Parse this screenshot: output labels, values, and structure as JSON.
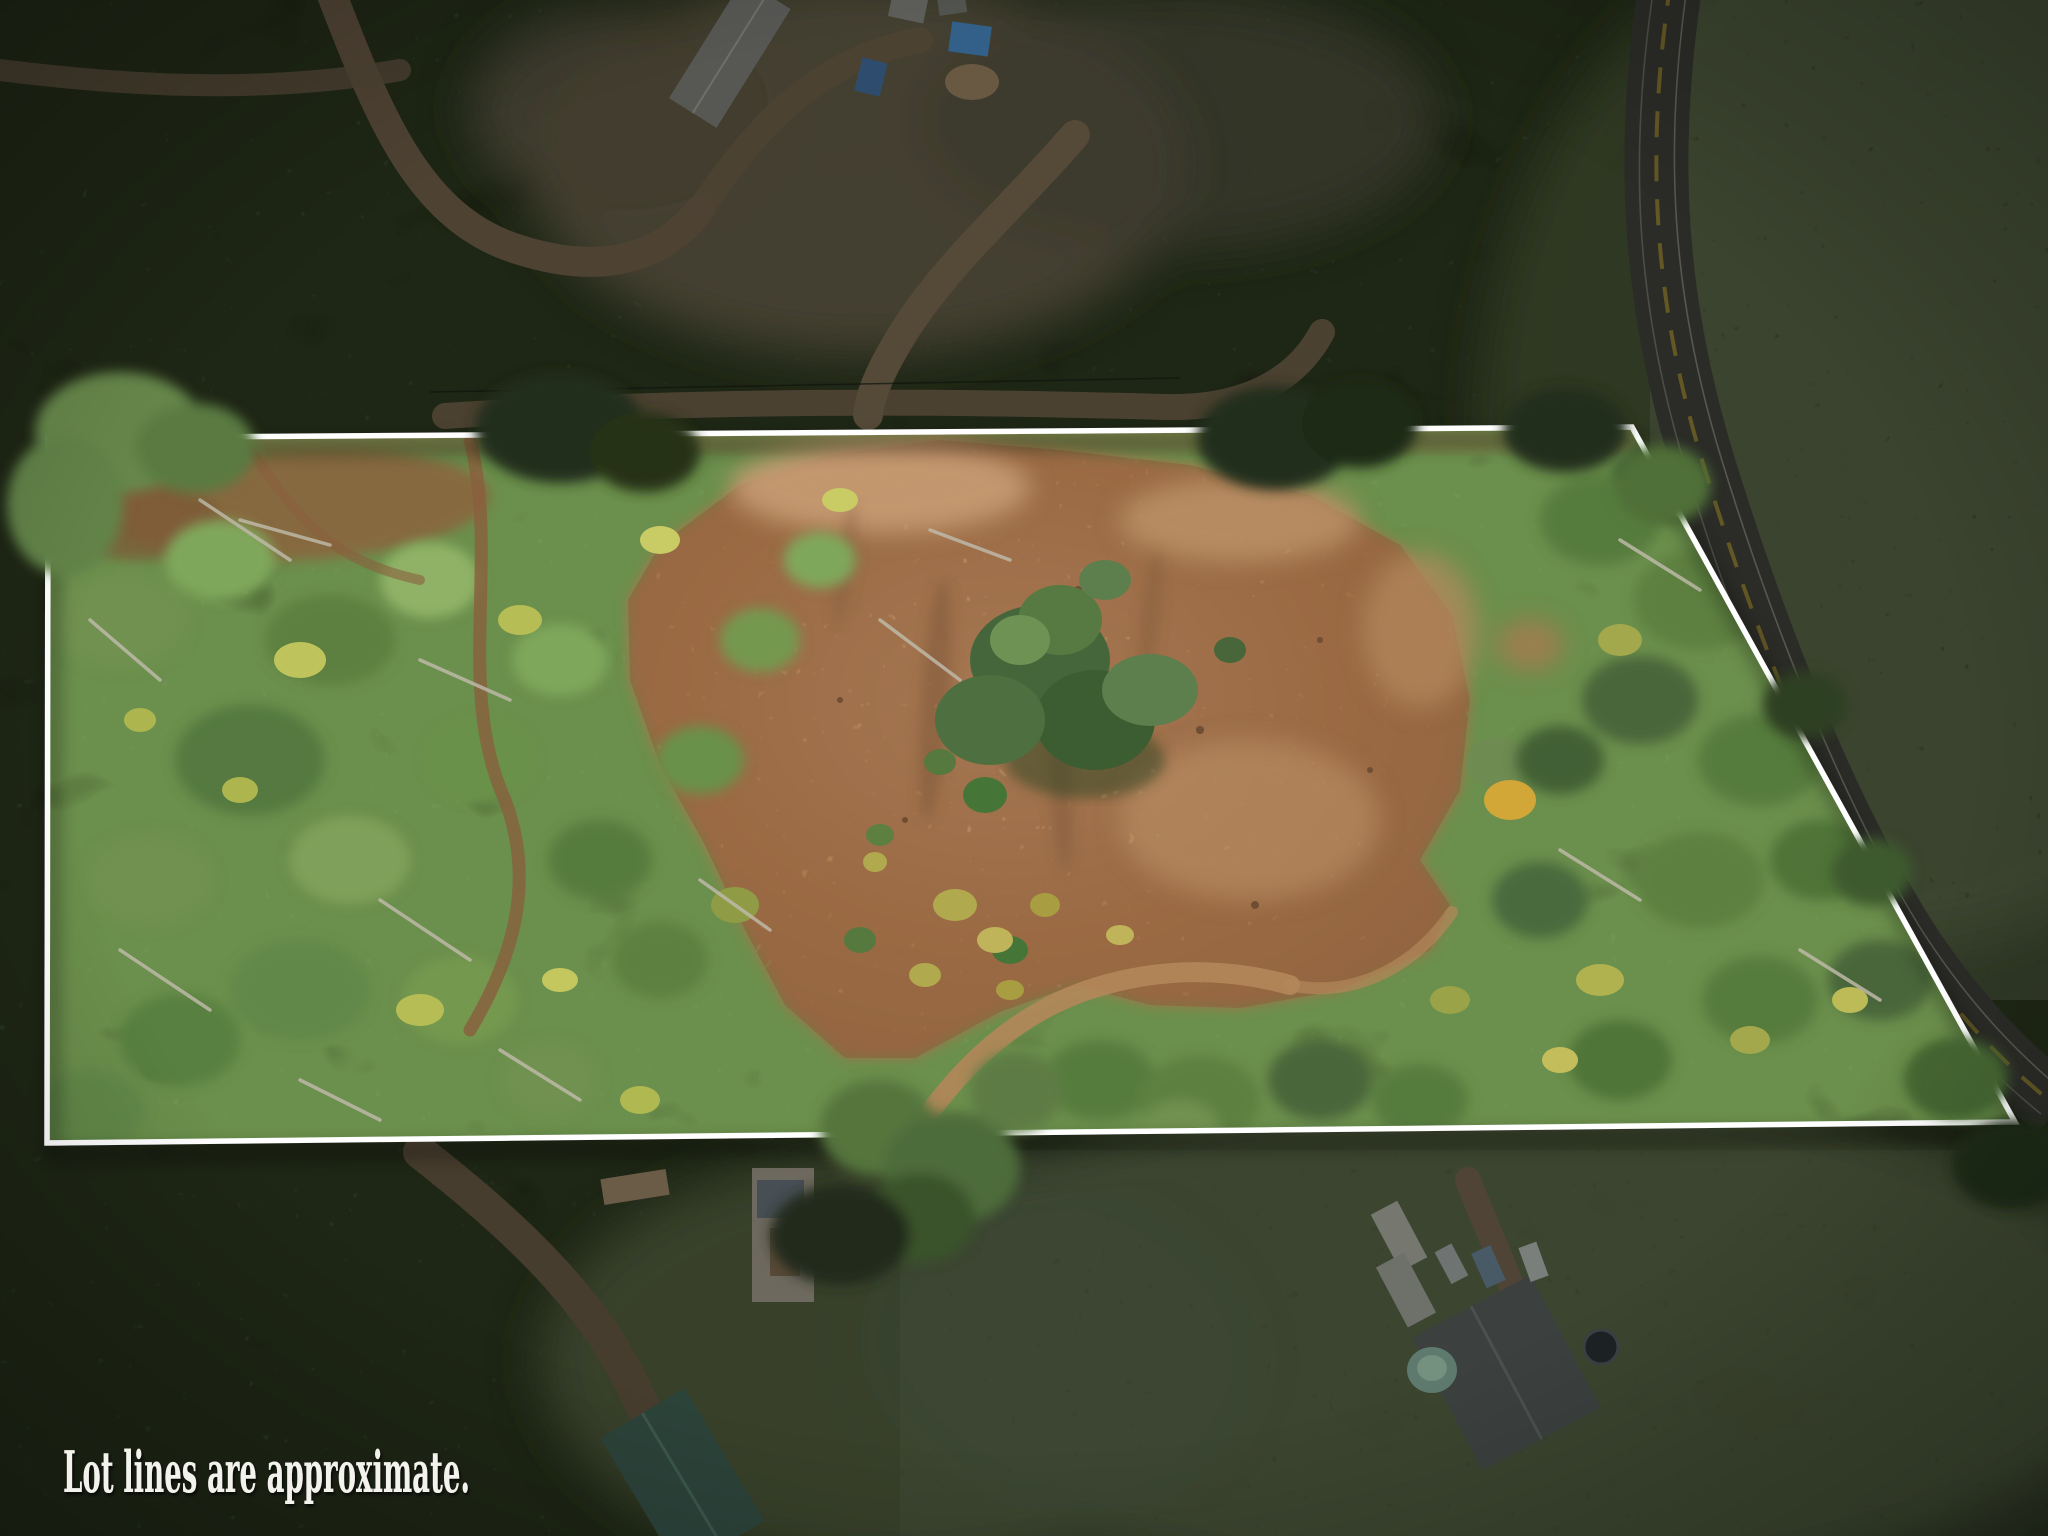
{
  "scene": {
    "type": "aerial-drone-photograph",
    "subject": "Top-down drone photo of a rectangular wooded lot outlined in white; interior is brightly lit with green tree canopy and a brown cleared dirt area, while everything outside the lot lines (neighboring homes, dirt roads, a paved road, fields and forest) is darkened",
    "caption": {
      "text": "Lot lines are approximate."
    }
  },
  "lot": {
    "polygon_points": "48,438 1632,427 2015,1122 47,1143",
    "boundary_color": "#ffffff"
  },
  "palette": {
    "boundary-white": "#ffffff",
    "caption-white": "#f4f2ec",
    "forest-dark": "#1d2414",
    "forest-dim": "#2a3420",
    "lot-green": "#5c7b42",
    "lot-green-light": "#7fa75c",
    "lot-yellow": "#bfc35c",
    "clearing-tan": "#b08052",
    "clearing-light": "#c69c74",
    "clearing-shadow": "#7d5839",
    "dead-wood-gray": "#beb9a8",
    "road-asphalt": "#2b2c27",
    "road-yellow": "#6d5f25",
    "dirt-road-brown": "#4e4233",
    "field-dim": "#39412c"
  }
}
